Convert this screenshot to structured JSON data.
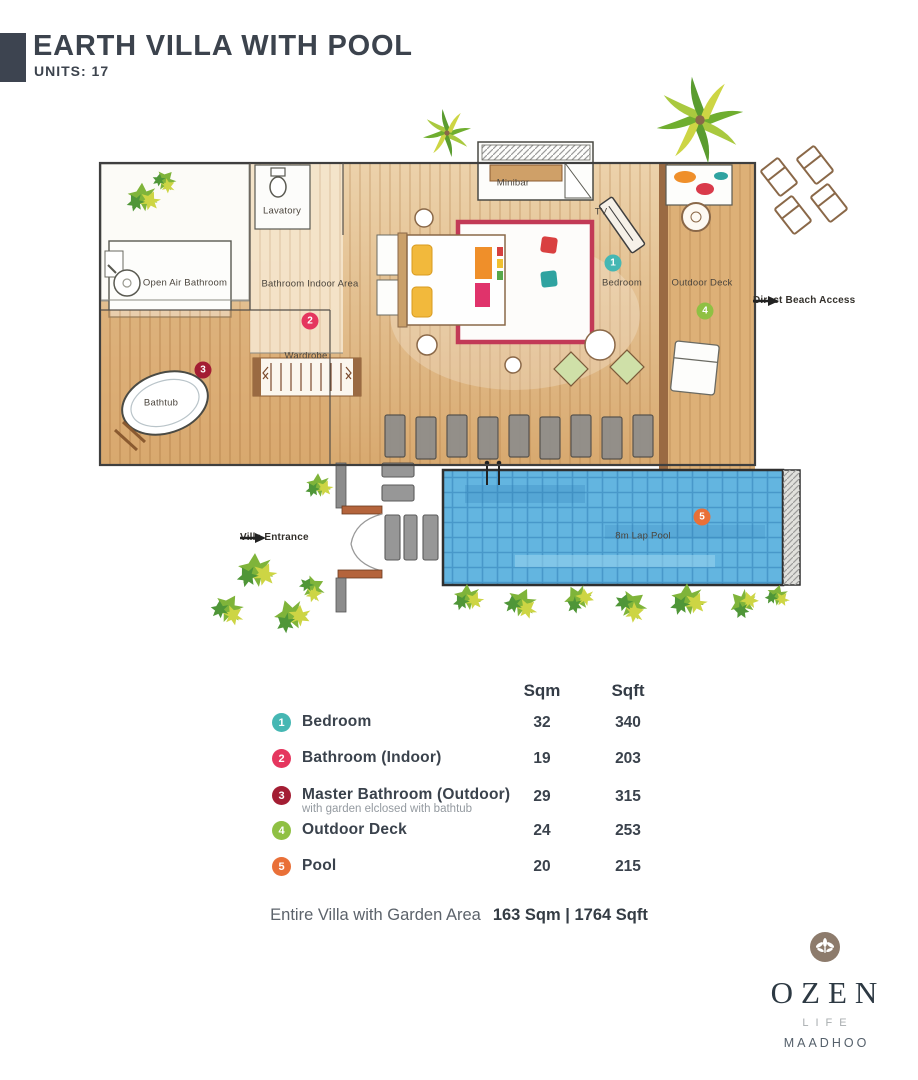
{
  "header": {
    "title": "EARTH VILLA WITH POOL",
    "units": "UNITS: 17"
  },
  "plan": {
    "labels": {
      "lavatory": "Lavatory",
      "open_air_bathroom": "Open Air Bathroom",
      "bathroom_indoor_area": "Bathroom Indoor Area",
      "wardrobe": "Wardrobe",
      "minibar": "Minibar",
      "tv": "TV",
      "bedroom": "Bedroom",
      "outdoor_deck": "Outdoor Deck",
      "bathtub": "Bathtub",
      "lap_pool": "8m Lap Pool",
      "villa_entrance": "Villa Entrance",
      "direct_beach_access": "Direct Beach Access"
    },
    "markers": [
      {
        "number": "1",
        "color": "#45b7b3"
      },
      {
        "number": "2",
        "color": "#e5365e"
      },
      {
        "number": "3",
        "color": "#a31d33"
      },
      {
        "number": "4",
        "color": "#8fc043"
      },
      {
        "number": "5",
        "color": "#e97038"
      }
    ]
  },
  "table": {
    "headers": {
      "sqm": "Sqm",
      "sqft": "Sqft"
    },
    "rows": [
      {
        "number": "1",
        "label": "Bedroom",
        "sqm": "32",
        "sqft": "340"
      },
      {
        "number": "2",
        "label": "Bathroom (Indoor)",
        "sqm": "19",
        "sqft": "203"
      },
      {
        "number": "3",
        "label": "Master Bathroom (Outdoor)",
        "note": "with garden elclosed with bathtub",
        "sqm": "29",
        "sqft": "315"
      },
      {
        "number": "4",
        "label": "Outdoor Deck",
        "sqm": "24",
        "sqft": "253"
      },
      {
        "number": "5",
        "label": "Pool",
        "sqm": "20",
        "sqft": "215"
      }
    ],
    "total_label": "Entire Villa with Garden Area",
    "total_value": "163 Sqm | 1764 Sqft"
  },
  "logo": {
    "brand": "OZEN",
    "line": "LIFE",
    "location": "MAADHOO"
  },
  "colors": {
    "accent_dark": "#3d4450",
    "marker_1": "#45b7b3",
    "marker_2": "#e5365e",
    "marker_3": "#a31d33",
    "marker_4": "#8fc043",
    "marker_5": "#e97038",
    "pool_blue": "#63b5e0",
    "wood": "#d8a96f",
    "logo_taupe": "#8d7b6c"
  }
}
